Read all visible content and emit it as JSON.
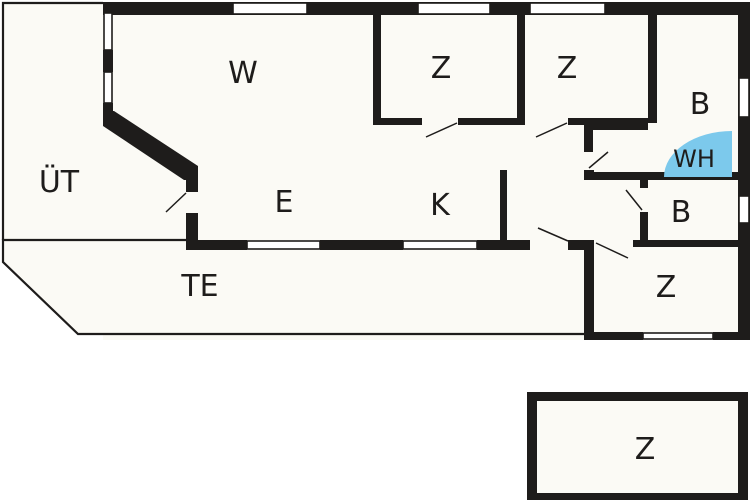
{
  "title": "Vacation house floor plan",
  "colors": {
    "wall": "#1e1c1b",
    "floor": "#fbfaf5",
    "background": "#ffffff",
    "window": "#ffffff",
    "whirlpool": "#7cc9ec",
    "text": "#1e1c1b"
  },
  "rooms": [
    {
      "id": "living-room",
      "label": "W"
    },
    {
      "id": "bedroom-1",
      "label": "Z"
    },
    {
      "id": "bedroom-2",
      "label": "Z"
    },
    {
      "id": "bathroom-1",
      "label": "B"
    },
    {
      "id": "whirlpool",
      "label": "WH"
    },
    {
      "id": "covered-terrace",
      "label": "ÜT"
    },
    {
      "id": "dining-area",
      "label": "E"
    },
    {
      "id": "kitchen",
      "label": "K"
    },
    {
      "id": "bathroom-2",
      "label": "B"
    },
    {
      "id": "bedroom-3",
      "label": "Z"
    },
    {
      "id": "terrace",
      "label": "TE"
    },
    {
      "id": "bedroom-annex",
      "label": "Z"
    }
  ]
}
